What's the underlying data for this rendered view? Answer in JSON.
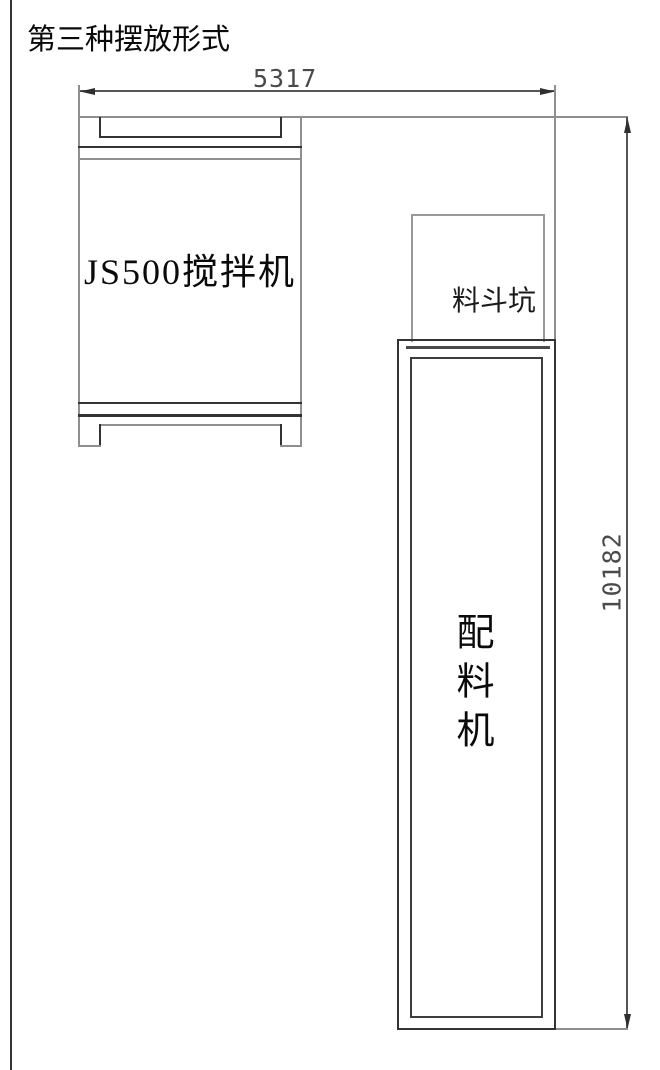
{
  "title": "第三种摆放形式",
  "labels": {
    "mixer": "JS500搅拌机",
    "hopper": "料斗坑",
    "batcher": "配料机"
  },
  "dimensions": {
    "width": "5317",
    "height": "10182"
  },
  "colors": {
    "line_dark": "#333333",
    "line_gray": "#8f8f8f",
    "dimension_line": "#555555",
    "text": "#0a0a0a",
    "dimension_text": "#4a4a4a",
    "background": "#ffffff"
  }
}
